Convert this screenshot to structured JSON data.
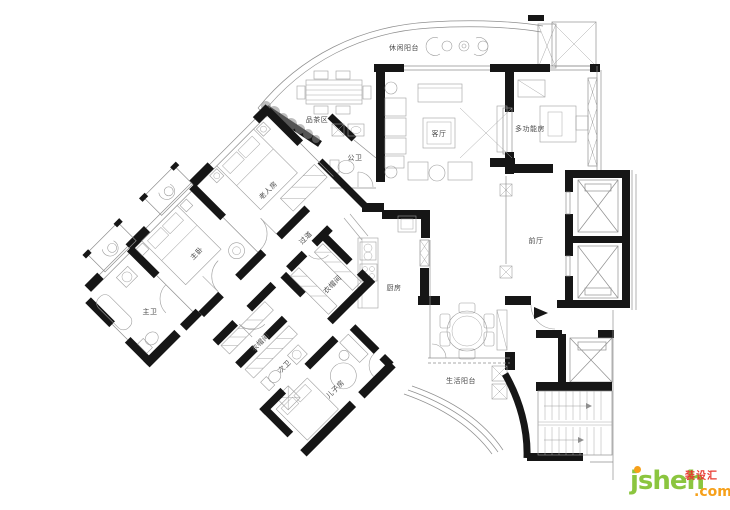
{
  "plan": {
    "rooms": [
      {
        "id": "leisure-balcony",
        "label": "休闲阳台"
      },
      {
        "id": "tea-area",
        "label": "品茶区"
      },
      {
        "id": "living-room",
        "label": "客厅"
      },
      {
        "id": "public-bath",
        "label": "公卫"
      },
      {
        "id": "multi-function-room",
        "label": "多功能房"
      },
      {
        "id": "foyer",
        "label": "前厅"
      },
      {
        "id": "kitchen",
        "label": "厨房"
      },
      {
        "id": "service-balcony",
        "label": "生活阳台"
      },
      {
        "id": "elder-room",
        "label": "老人房"
      },
      {
        "id": "master-bedroom",
        "label": "主卧"
      },
      {
        "id": "master-bath",
        "label": "主卫"
      },
      {
        "id": "closet-a",
        "label": "衣帽间"
      },
      {
        "id": "hallway",
        "label": "过道"
      },
      {
        "id": "closet-b",
        "label": "衣帽间"
      },
      {
        "id": "second-bath",
        "label": "次卫"
      },
      {
        "id": "son-room",
        "label": "儿子房"
      }
    ]
  },
  "watermark": {
    "brand": "jsheh",
    "cn": "装设汇",
    "tld": ".com",
    "green": "#8bc53f",
    "orange": "#f6a01a",
    "red": "#e8382f"
  }
}
